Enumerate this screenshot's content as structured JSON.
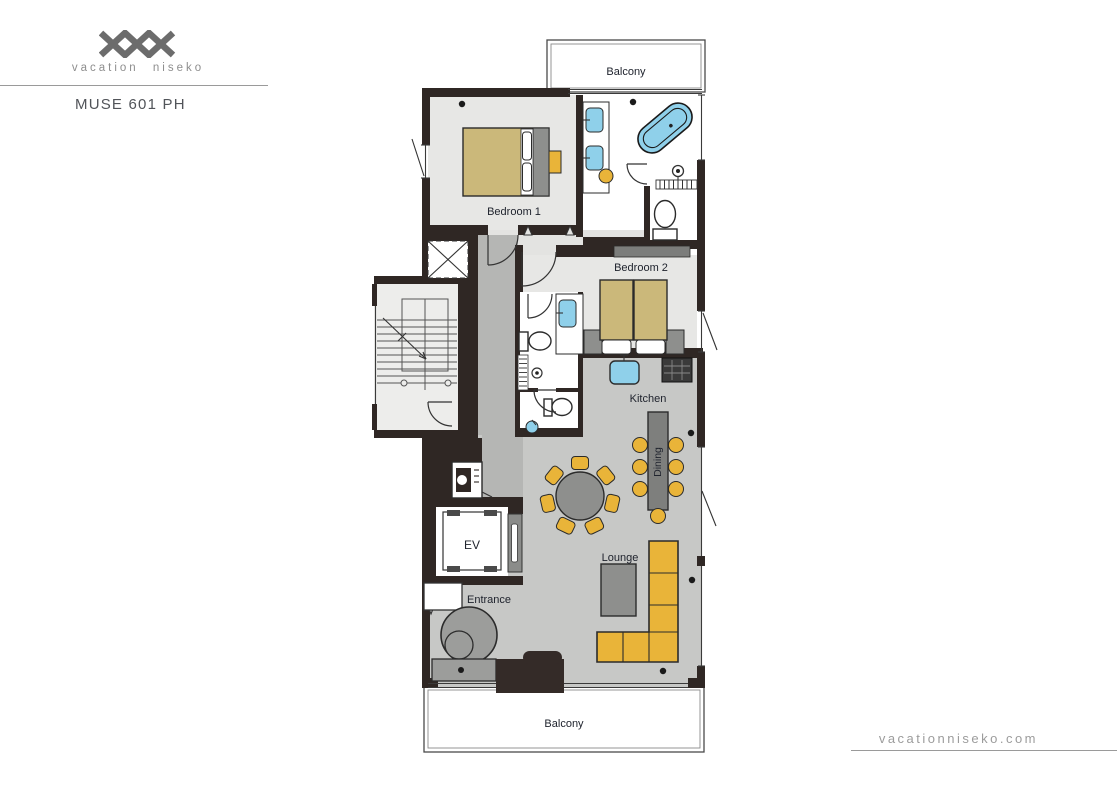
{
  "header": {
    "logo_text": "vacation niseko",
    "title": "MUSE 601 PH"
  },
  "footer": {
    "website": "vacationniseko.com"
  },
  "floorplan": {
    "labels": {
      "balcony_top": "Balcony",
      "bedroom_1": "Bedroom 1",
      "bedroom_2": "Bedroom 2",
      "kitchen": "Kitchen",
      "dining": "Dining",
      "lounge": "Lounge",
      "elevator": "EV",
      "entrance": "Entrance",
      "balcony_bottom": "Balcony"
    },
    "colors": {
      "wall": "#2f2724",
      "floor_light": "#e7e7e5",
      "floor_mid": "#c7c8c6",
      "floor_corridor": "#b5b6b4",
      "floor_stairs": "#ededeb",
      "bed_tan": "#cbb87a",
      "furniture_yellow": "#e9b439",
      "fixture_blue": "#8fd0ea",
      "furniture_gray": "#8e8f8d",
      "island_gray": "#7e7f7d",
      "closet_gray": "#7c7d7b",
      "hearth_dark": "#342b28",
      "label_text": "#20242e",
      "logo_gray": "#6c6c6c",
      "muted_text": "#8e8e8e",
      "line_gray": "#9a9a9a"
    }
  }
}
